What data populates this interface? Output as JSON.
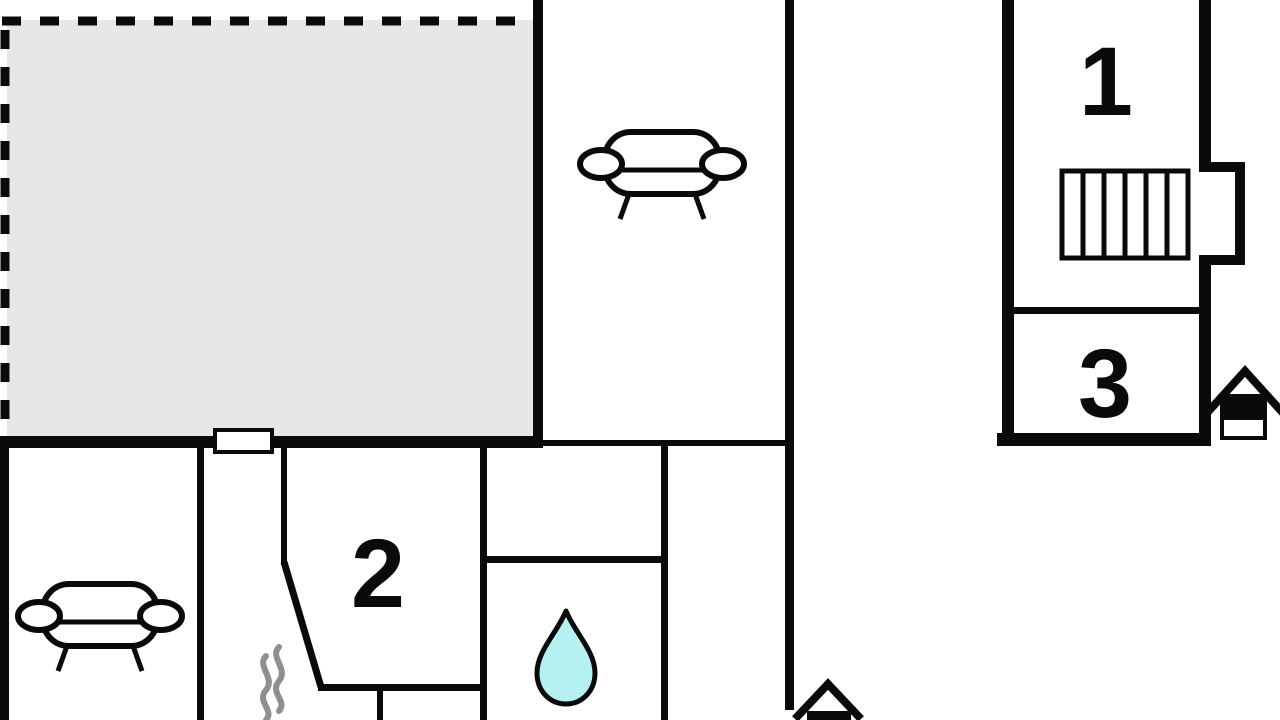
{
  "floor_plan": {
    "rooms": {
      "room1": {
        "label": "1"
      },
      "room2": {
        "label": "2"
      },
      "room3": {
        "label": "3"
      }
    },
    "colors": {
      "wall": "#0a0a0a",
      "terrace_fill": "#e7e7ea",
      "water_drop_fill": "#b5f0f2",
      "steam": "#8f8f8f",
      "background": "#ffffff"
    },
    "icons": {
      "sofa_upper": "sofa-icon",
      "sofa_lower": "sofa-icon",
      "stairs": "stairs-icon",
      "water_drop": "water-drop-icon",
      "steam": "steam-icon",
      "house_entrance_right": "house-icon",
      "house_entrance_bottom": "house-icon",
      "terrace_door": "window-icon"
    }
  }
}
